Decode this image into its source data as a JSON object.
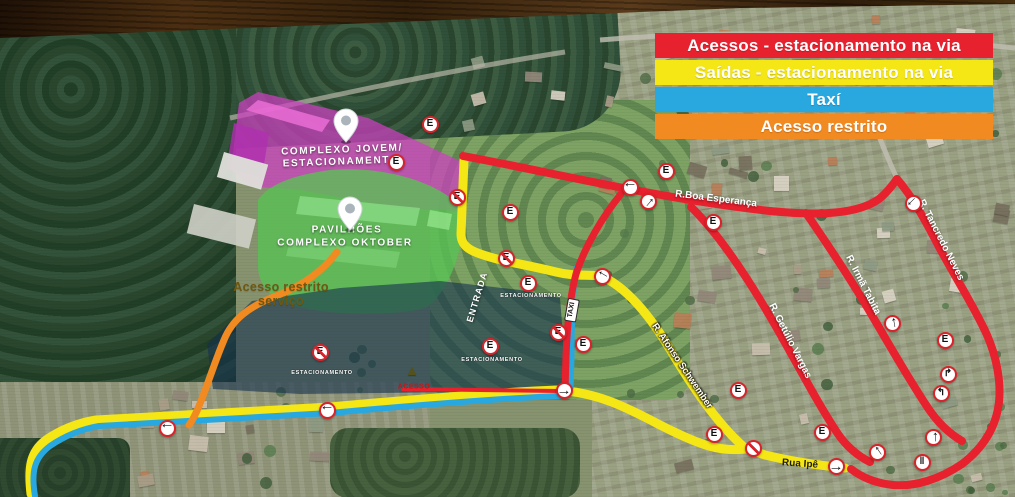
{
  "legend": {
    "items": [
      {
        "id": "acessos",
        "label": "Acessos - estacionamento na via",
        "color": "#e8212e",
        "text_color": "#ffffff"
      },
      {
        "id": "saidas",
        "label": "Saídas - estacionamento na via",
        "color": "#f5e615",
        "text_color": "#ffffff"
      },
      {
        "id": "taxi",
        "label": "Taxí",
        "color": "#29a8e0",
        "text_color": "#ffffff"
      },
      {
        "id": "restrito",
        "label": "Acesso restrito",
        "color": "#f18a21",
        "text_color": "#ffffff"
      }
    ]
  },
  "areas": {
    "complexo_jovem_fill": "#cf3fc2",
    "pavilhoes_fill": "#57c353",
    "estacionamento_fill": "#14304e"
  },
  "map_labels": [
    {
      "text": "COMPLEXO JOVEM/",
      "x": 342,
      "y": 150,
      "rot": -2,
      "cls": "area-label"
    },
    {
      "text": "ESTACIONAMENTO",
      "x": 341,
      "y": 162,
      "rot": -2,
      "cls": "area-label"
    },
    {
      "text": "PAVILHÕES",
      "x": 347,
      "y": 230,
      "rot": 0,
      "cls": "area-label"
    },
    {
      "text": "COMPLEXO OKTOBER",
      "x": 345,
      "y": 243,
      "rot": 0,
      "cls": "area-label"
    },
    {
      "text": "Acesso restrito",
      "x": 281,
      "y": 287,
      "rot": 0,
      "cls": "restrito-label"
    },
    {
      "text": "serviço",
      "x": 281,
      "y": 301,
      "rot": 0,
      "cls": "restrito-label"
    },
    {
      "text": "R.Boa Esperança",
      "x": 716,
      "y": 199,
      "rot": 7,
      "cls": "street-on-red"
    },
    {
      "text": "R. Tancredo Neves",
      "x": 941,
      "y": 240,
      "rot": 63,
      "cls": "street-on-red"
    },
    {
      "text": "R. Irmã Tabita",
      "x": 863,
      "y": 285,
      "rot": 63,
      "cls": "street-on-red"
    },
    {
      "text": "R. Getúlio Vargas",
      "x": 790,
      "y": 341,
      "rot": 63,
      "cls": "street-on-red"
    },
    {
      "text": "R. Afonso Schwember",
      "x": 682,
      "y": 366,
      "rot": 56,
      "cls": "street-on-yellow"
    },
    {
      "text": "Rua Ipê",
      "x": 800,
      "y": 464,
      "rot": 4,
      "cls": "street-dark"
    },
    {
      "text": "ENTRADA",
      "x": 477,
      "y": 297,
      "rot": -73,
      "cls": "entrada-label"
    },
    {
      "text": "TAXI",
      "x": 572,
      "y": 310,
      "rot": -80,
      "cls": "taxi-label"
    },
    {
      "text": "ACESSO",
      "x": 414,
      "y": 387,
      "rot": 0,
      "cls": "acesso-label"
    },
    {
      "text": "ESTACIONAMENTO",
      "x": 531,
      "y": 296,
      "rot": 0,
      "cls": "tiny-label"
    },
    {
      "text": "ESTACIONAMENTO",
      "x": 492,
      "y": 360,
      "rot": 0,
      "cls": "tiny-label"
    },
    {
      "text": "ESTACIONAMENTO",
      "x": 322,
      "y": 373,
      "rot": 0,
      "cls": "tiny-label"
    },
    {
      "text": "▲",
      "x": 412,
      "y": 370,
      "rot": 0,
      "cls": "dark-arrow"
    }
  ],
  "signs": [
    {
      "type": "e",
      "x": 430,
      "y": 124
    },
    {
      "type": "e",
      "x": 396,
      "y": 162
    },
    {
      "type": "e-slash",
      "x": 457,
      "y": 197
    },
    {
      "type": "e",
      "x": 510,
      "y": 212
    },
    {
      "type": "e-slash",
      "x": 506,
      "y": 258
    },
    {
      "type": "e",
      "x": 666,
      "y": 171
    },
    {
      "type": "e",
      "x": 713,
      "y": 222
    },
    {
      "type": "e",
      "x": 528,
      "y": 283
    },
    {
      "type": "e",
      "x": 490,
      "y": 346
    },
    {
      "type": "e-slash",
      "x": 320,
      "y": 352
    },
    {
      "type": "e",
      "x": 583,
      "y": 344
    },
    {
      "type": "e-slash",
      "x": 558,
      "y": 332
    },
    {
      "type": "e",
      "x": 738,
      "y": 390
    },
    {
      "type": "e",
      "x": 714,
      "y": 434
    },
    {
      "type": "e",
      "x": 822,
      "y": 432
    },
    {
      "type": "e",
      "x": 945,
      "y": 340
    },
    {
      "type": "no-parking",
      "x": 753,
      "y": 448
    },
    {
      "type": "arrow",
      "x": 167,
      "y": 428,
      "rot": 180
    },
    {
      "type": "arrow",
      "x": 327,
      "y": 410,
      "rot": 180
    },
    {
      "type": "arrow",
      "x": 564,
      "y": 390,
      "rot": 0
    },
    {
      "type": "arrow",
      "x": 602,
      "y": 276,
      "rot": 210
    },
    {
      "type": "arrow",
      "x": 630,
      "y": 187,
      "rot": 180
    },
    {
      "type": "arrow",
      "x": 648,
      "y": 201,
      "rot": -50
    },
    {
      "type": "arrow",
      "x": 836,
      "y": 466,
      "rot": 0
    },
    {
      "type": "arrow",
      "x": 913,
      "y": 203,
      "rot": 135
    },
    {
      "type": "arrow",
      "x": 892,
      "y": 323,
      "rot": -100
    },
    {
      "type": "arrow",
      "x": 933,
      "y": 437,
      "rot": -90
    },
    {
      "type": "arrow",
      "x": 877,
      "y": 452,
      "rot": -125
    },
    {
      "type": "turn-right",
      "x": 948,
      "y": 374
    },
    {
      "type": "turn-left",
      "x": 941,
      "y": 393
    },
    {
      "type": "double-bar",
      "x": 922,
      "y": 462
    }
  ],
  "sign_glyphs": {
    "e": "E",
    "arrow": "→",
    "turn_left": "↰",
    "turn_right": "↱",
    "double_bar": "‖"
  }
}
